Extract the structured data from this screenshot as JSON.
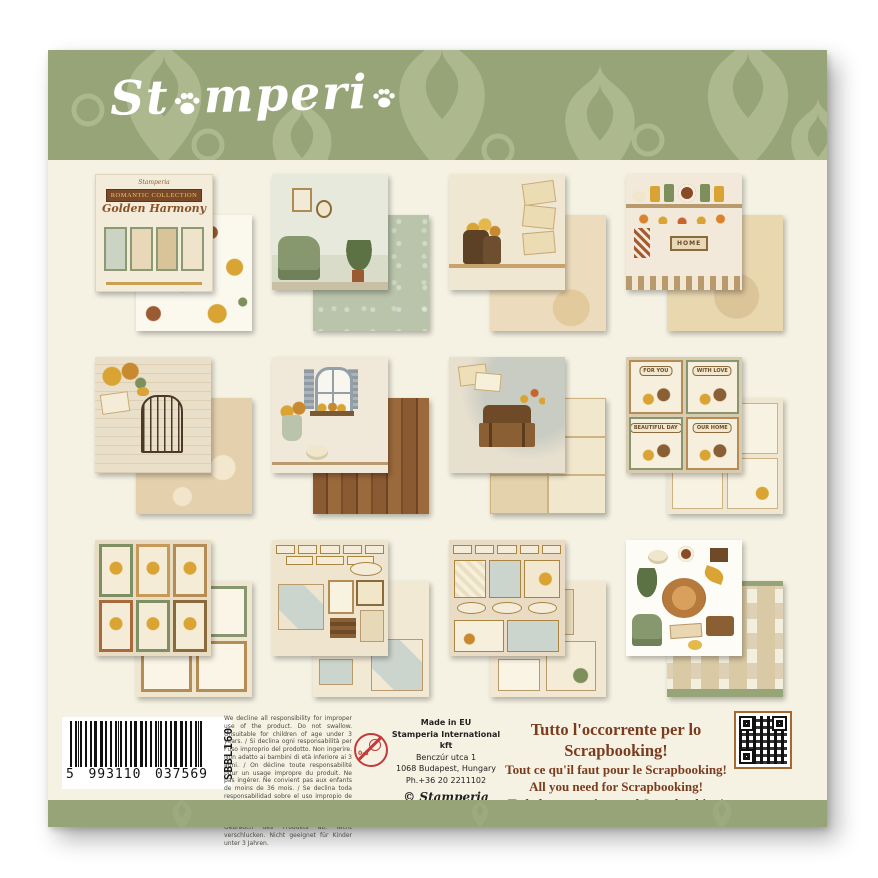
{
  "brand": {
    "logo_pre": "St",
    "logo_mid": "mperi",
    "logo_name": "Stamperia"
  },
  "items": [
    {
      "title": "Cover sheet – Romantic Collection Golden Harmony scrapbook pad",
      "banner": "ROMANTIC COLLECTION",
      "script_title": "Golden Harmony",
      "brand": "Stamperia",
      "back_desc": "yellow flowers on white pattern sheet"
    },
    {
      "title": "Living room scene with green armchair, wall frames and plants",
      "back_desc": "sage green floral texture sheet"
    },
    {
      "title": "Boots with yellow flowers beside stacked letters",
      "back_desc": "aged beige texture sheet"
    },
    {
      "title": "Kitchen shelf with jars, alarm clock, pumpkins and leaf garland",
      "home_sign": "HOME",
      "back_desc": "aged paper texture sheet"
    },
    {
      "title": "Birdcage with yellow bird and golden roses on handwritten letter",
      "back_desc": "beige damask pattern sheet"
    },
    {
      "title": "Open window with shutters, flower vase and pumpkin",
      "back_desc": "wood plank pattern sheet"
    },
    {
      "title": "Open suitcase with books, papers and butterflies",
      "back_desc": "vintage postcards collage sheet"
    },
    {
      "title": "Four framed square cards",
      "cards": [
        "FOR YOU",
        "WITH LOVE",
        "BEAUTIFUL DAY",
        "OUR HOME"
      ],
      "back_desc": "journaling cards sheet"
    },
    {
      "title": "Six framed cards with birds, flowers and butterflies",
      "back_desc": "empty photo frames sheet"
    },
    {
      "title": "Quote labels, tiles and small frames sheet",
      "back_desc": "frames and diamond tiles sheet"
    },
    {
      "title": "Tags, labels and journaling boxes sheet",
      "back_desc": "journaling tags sheet"
    },
    {
      "title": "Die-cut elements: wood slice, pumpkins, plants, armchair, clock, books",
      "back_desc": "miniature of the pack back cover"
    }
  ],
  "footer": {
    "barcode": {
      "lead": "5",
      "group1": "993110",
      "group2": "037569",
      "sku": "SBBL160"
    },
    "legal": "We decline all responsibility for improper use of the product. Do not swallow. Unsuitable for children of age under 3 years. / Si declina ogni responsabilità per l'uso improprio del prodotto. Non ingerire. Non adatto ai bambini di età inferiore ai 3 anni. / On décline toute responsabilité pour un usage impropre du produit. Ne pas ingérer. Ne convient pas aux enfants de moins de 36 mois. / Se declina toda responsabilidad sobre el uso impropio de este producto. No ingerir. No apto para niños menores de 3 años. / Wir lehnen jede Verantwortung für unsachgemäßen Gebrauch des Produkts ab. Nicht verschlucken. Nicht geeignet für Kinder unter 3 Jahren.",
    "age_warning": "0-3",
    "made_in": {
      "line1": "Made in EU",
      "line2": "Stamperia International kft",
      "line3": "Benczúr utca 1",
      "line4": "1068 Budapest, Hungary",
      "line5": "Ph.+36 20 2211102",
      "copyright": "© Stamperia"
    },
    "marketing": {
      "line1": "Tutto l'occorrente per lo Scrapbooking!",
      "line2": "Tout ce qu'il faut pour le Scrapbooking!",
      "line3": "All you need for Scrapbooking!",
      "line4": "Todo lo necesario por el Scrapbooking!"
    }
  },
  "colors": {
    "band_green": "#96a477",
    "damask_light": "#adb88e",
    "panel_cream": "#f5f2e3",
    "marketing_brown": "#7b3c1e",
    "qr_border": "#a5682f"
  }
}
